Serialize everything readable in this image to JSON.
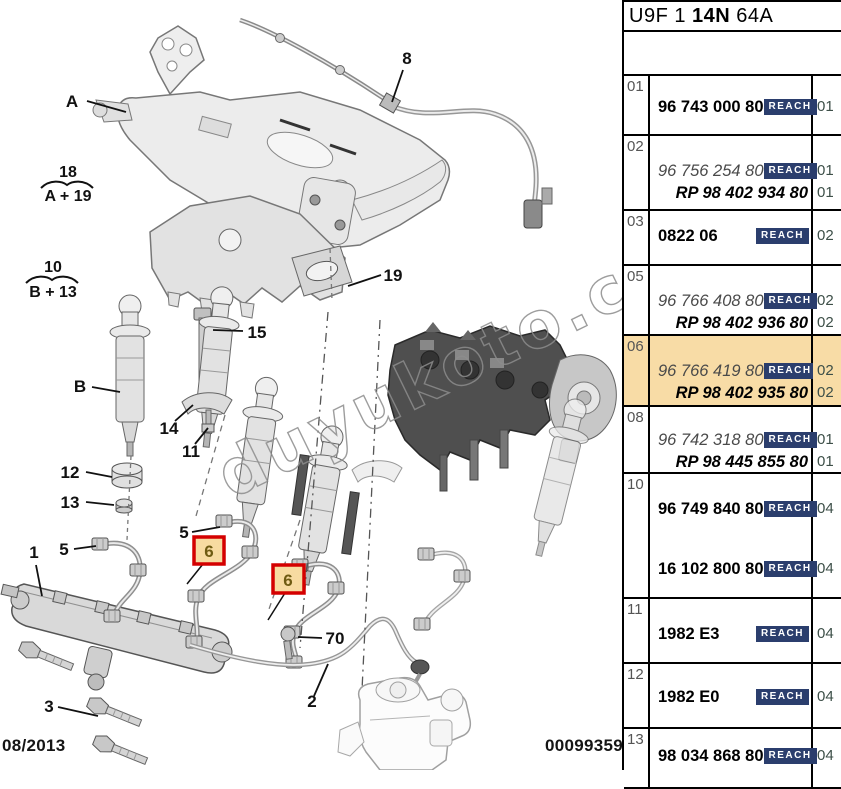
{
  "header": {
    "code_prefix": "U9F 1",
    "code_bold": "14N",
    "code_suffix": "64A"
  },
  "footer": {
    "date": "08/2013",
    "doc_number": "00099359"
  },
  "watermark": "duyukoto.com",
  "colors": {
    "highlight": "#f8dca6",
    "reach_bg": "#2b3e6d",
    "callout_box_red": "#d40000"
  },
  "diagram": {
    "callouts": {
      "A": "A",
      "B": "B",
      "1": "1",
      "2": "2",
      "3": "3",
      "5": "5",
      "6": "6",
      "8": "8",
      "11": "11",
      "12": "12",
      "13": "13",
      "14": "14",
      "15": "15",
      "19": "19",
      "70": "70"
    },
    "formulas": [
      {
        "top": "18",
        "bottom": "A + 19"
      },
      {
        "top": "10",
        "bottom": "B + 13"
      }
    ]
  },
  "table": {
    "reach_label": "REACH",
    "rows": [
      {
        "ref": "01",
        "height": 60,
        "highlight": false,
        "lines": [
          {
            "text": "96 743 000 80",
            "style": "bold",
            "reach": true,
            "qty": "01",
            "top": 20
          }
        ]
      },
      {
        "ref": "02",
        "height": 75,
        "highlight": false,
        "lines": [
          {
            "text": "96 756 254 80",
            "style": "italic",
            "reach": true,
            "qty": "01",
            "top": 24
          },
          {
            "text": "RP 98 402 934 80",
            "style": "rp",
            "reach": false,
            "qty": "01",
            "top": 46
          }
        ]
      },
      {
        "ref": "03",
        "height": 55,
        "highlight": false,
        "lines": [
          {
            "text": "0822 06",
            "style": "bold",
            "reach": true,
            "qty": "02",
            "top": 14
          }
        ]
      },
      {
        "ref": "05",
        "height": 70,
        "highlight": false,
        "lines": [
          {
            "text": "96 766 408 80",
            "style": "italic",
            "reach": true,
            "qty": "02",
            "top": 24
          },
          {
            "text": "RP 98 402 936 80",
            "style": "rp",
            "reach": false,
            "qty": "02",
            "top": 46
          }
        ]
      },
      {
        "ref": "06",
        "height": 71,
        "highlight": true,
        "lines": [
          {
            "text": "96 766 419 80",
            "style": "italic",
            "reach": true,
            "qty": "02",
            "top": 24
          },
          {
            "text": "RP 98 402 935 80",
            "style": "rp",
            "reach": false,
            "qty": "02",
            "top": 46
          }
        ]
      },
      {
        "ref": "08",
        "height": 67,
        "highlight": false,
        "lines": [
          {
            "text": "96 742 318 80",
            "style": "italic",
            "reach": true,
            "qty": "01",
            "top": 22
          },
          {
            "text": "RP 98 445 855 80",
            "style": "rp",
            "reach": false,
            "qty": "01",
            "top": 44
          }
        ]
      },
      {
        "ref": "10",
        "height": 125,
        "highlight": false,
        "lines": [
          {
            "text": "96 749 840 80",
            "style": "bold",
            "reach": true,
            "qty": "04",
            "top": 24
          },
          {
            "text": "16 102 800 80",
            "style": "bold",
            "reach": true,
            "qty": "04",
            "top": 84
          }
        ]
      },
      {
        "ref": "11",
        "height": 65,
        "highlight": false,
        "lines": [
          {
            "text": "1982 E3",
            "style": "bold",
            "reach": true,
            "qty": "04",
            "top": 24
          }
        ]
      },
      {
        "ref": "12",
        "height": 65,
        "highlight": false,
        "lines": [
          {
            "text": "1982 E0",
            "style": "bold",
            "reach": true,
            "qty": "04",
            "top": 22
          }
        ]
      },
      {
        "ref": "13",
        "height": 60,
        "highlight": false,
        "lines": [
          {
            "text": "98 034 868 80",
            "style": "bold",
            "reach": true,
            "qty": "04",
            "top": 16
          }
        ]
      }
    ]
  }
}
